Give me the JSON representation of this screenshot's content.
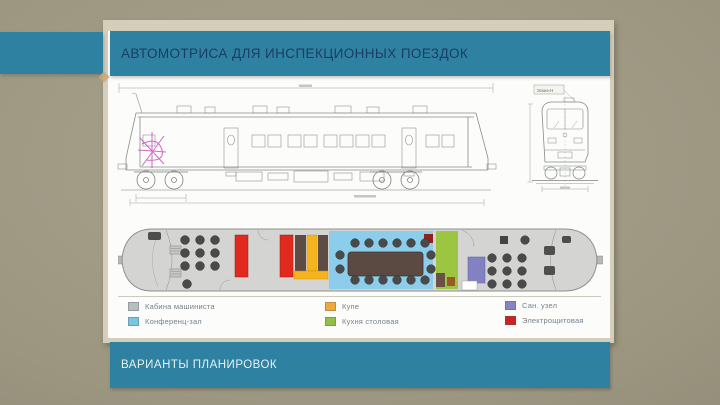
{
  "slide": {
    "title": "АВТОМОТРИСА ДЛЯ ИНСПЕКЦИОННЫХ ПОЕЗДОК",
    "footer": "ВАРИАНТЫ ПЛАНИРОВОК",
    "colors": {
      "accent_teal": "#2f81a1",
      "background_taupe": "#9c9681",
      "title_text": "#1b3d63",
      "footer_text": "#e4f1f6",
      "panel_frame": "#d5cebb"
    }
  },
  "diagrams": {
    "side_view": {
      "name": "railcar side elevation technical drawing"
    },
    "front_view": {
      "name": "railcar front elevation technical drawing",
      "annotation": "Эскиз-Н"
    },
    "floor_plan": {
      "name": "railcar interior layout plan"
    }
  },
  "legend": {
    "items": [
      {
        "label": "Кабина машиниста",
        "color": "#b7bfc3"
      },
      {
        "label": "Конференц-зал",
        "color": "#7cc4e4"
      },
      {
        "label": "Купе",
        "color": "#f2a93c"
      },
      {
        "label": "Кухня столовая",
        "color": "#8fc043"
      },
      {
        "label": "Сан. узел",
        "color": "#8585c6"
      },
      {
        "label": "Электрощитовая",
        "color": "#cc2222"
      }
    ]
  }
}
